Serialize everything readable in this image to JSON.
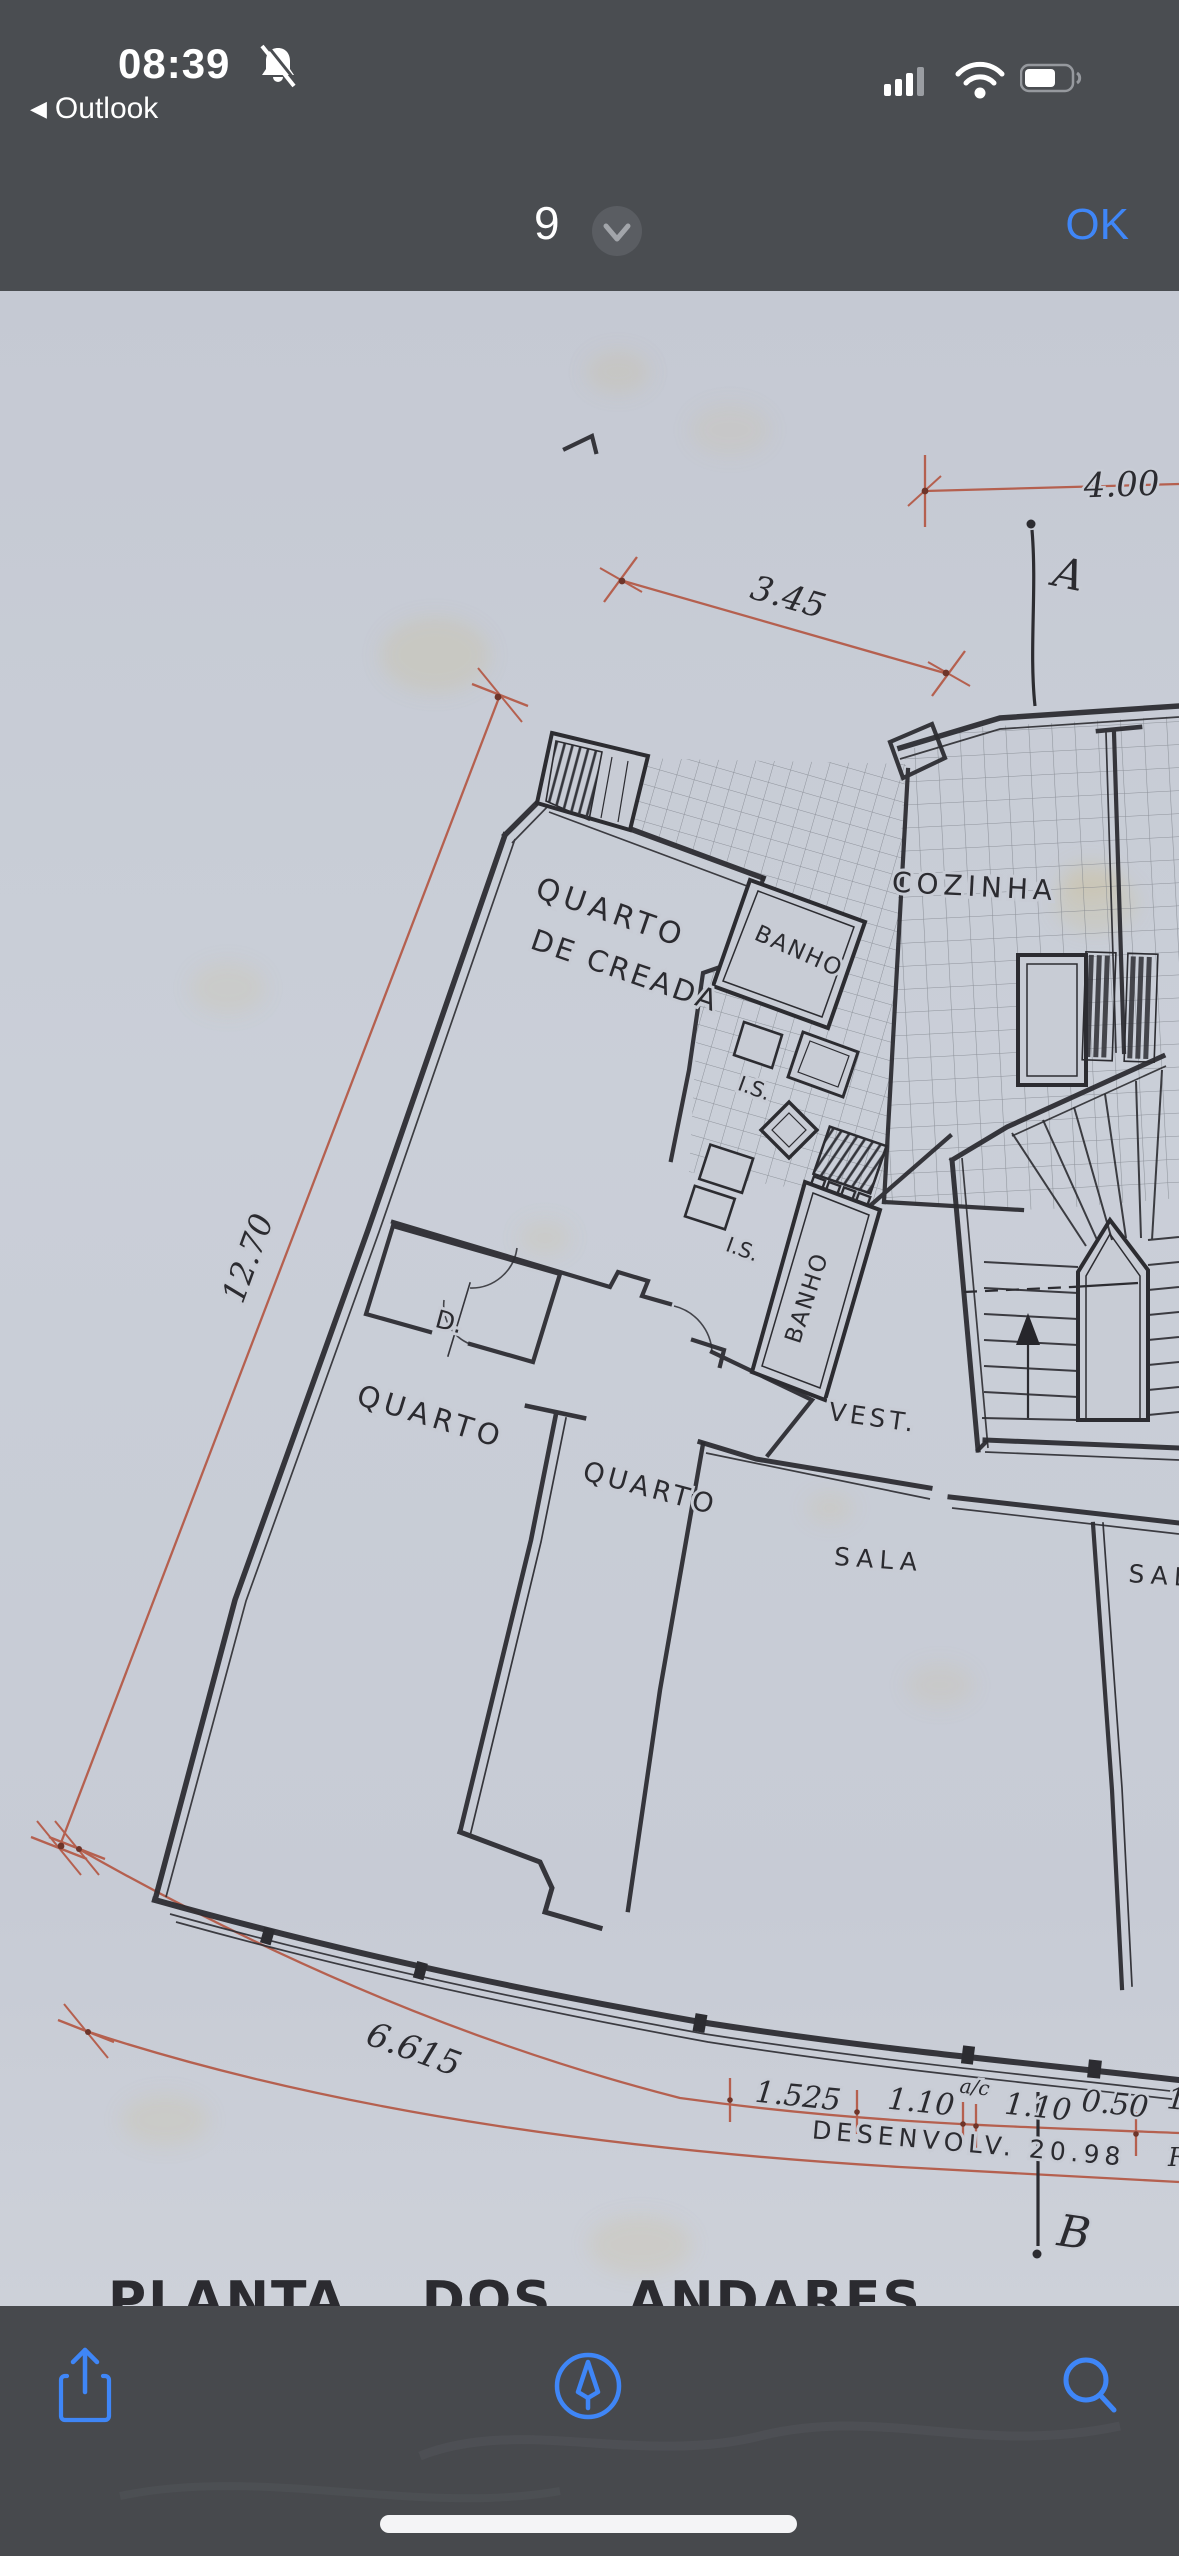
{
  "status_bar": {
    "time": "08:39",
    "back_arrow": "◀",
    "back_label": "Outlook",
    "notifications_muted": true
  },
  "nav_bar": {
    "page_indicator": "9",
    "confirm_label": "OK"
  },
  "plan": {
    "title": "PLANTA DOS ANDARES",
    "rooms": {
      "maid_room_line1": "QUARTO",
      "maid_room_line2": "DE CREADA",
      "bath_upper": "BANHO",
      "bath_lower": "BANHO",
      "wc_upper": "I.S.",
      "wc_lower": "I.S.",
      "kitchen": "COZINHA",
      "closet": "D.",
      "bedroom_left": "QUARTO",
      "bedroom_center": "QUARTO",
      "vestibule": "VEST.",
      "living_room": "SALA",
      "living_room_2": "SALA"
    },
    "dims": {
      "top_right": "4.00",
      "top_diag": "3.45",
      "left_side": "12.70",
      "bottom_arc": "6.615",
      "chain_1": "1.525",
      "chain_2": "1.10",
      "chain_note": "a/c",
      "chain_3": "1.10",
      "chain_4": "0.50",
      "chain_5": "1.",
      "development": "DESENVOLV. 20.98"
    },
    "sections": {
      "marker_a": "A",
      "marker_b": "B"
    },
    "fragments": {
      "right_edge": "R"
    }
  },
  "toolbar": {
    "icons": [
      "share-icon",
      "markup-icon",
      "search-icon"
    ]
  },
  "colors": {
    "chrome": "#4a4d51",
    "paper": "#c8ccd5",
    "ink": "#2c2c31",
    "dimension_red": "#b5604f",
    "accent_blue": "#3f86f7"
  }
}
